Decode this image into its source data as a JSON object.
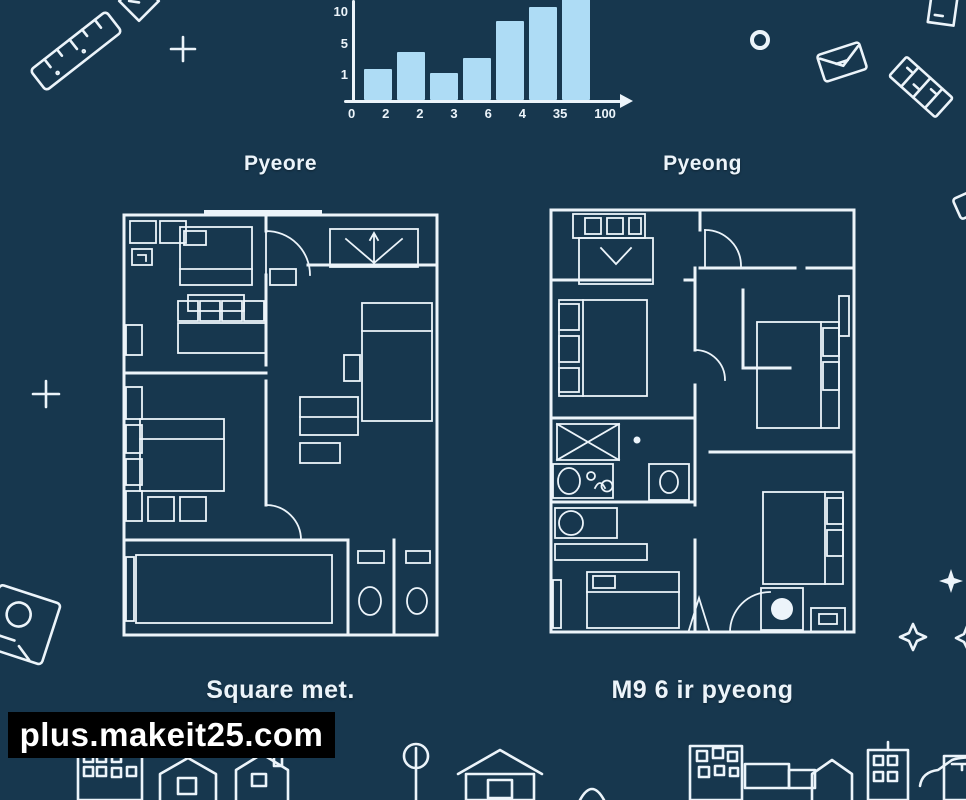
{
  "canvas": {
    "background": "#17374e",
    "ink": "#ecf4fa"
  },
  "chart_data": {
    "type": "bar",
    "title": "",
    "xlabel": "",
    "ylabel": "",
    "values": [
      3.3,
      5.2,
      2.9,
      4.5,
      8.5,
      10,
      11.3
    ],
    "x_tick_labels": [
      "0",
      "2",
      "2",
      "3",
      "6",
      "4",
      "35",
      "100"
    ],
    "y_tick_labels": [
      "10",
      "5",
      "1"
    ],
    "ylim": [
      0,
      11.3
    ],
    "bar_color": "#aedcf5",
    "axis_color": "#ecf4fa",
    "grid": false,
    "legend": false,
    "note": "hand-drawn style histogram, tallest bar clipped by top edge"
  },
  "plans": {
    "left": {
      "title": "Pyeore",
      "caption": "Square met."
    },
    "right": {
      "title": "Pyeong",
      "caption": "M9 6 ir pyeong"
    }
  },
  "watermark": {
    "text": "plus.makeit25.com",
    "background": "#000000",
    "color": "#ffffff"
  },
  "decorations": [
    "ruler-icon",
    "plus-icon",
    "roof-icon",
    "circle-icon",
    "envelope-icon",
    "tilted-ruler-icon",
    "frame-icon",
    "plus-icon-2",
    "house-card-icon",
    "sparkle-icon",
    "diamond-sparkle-icon",
    "building-icons-row"
  ]
}
